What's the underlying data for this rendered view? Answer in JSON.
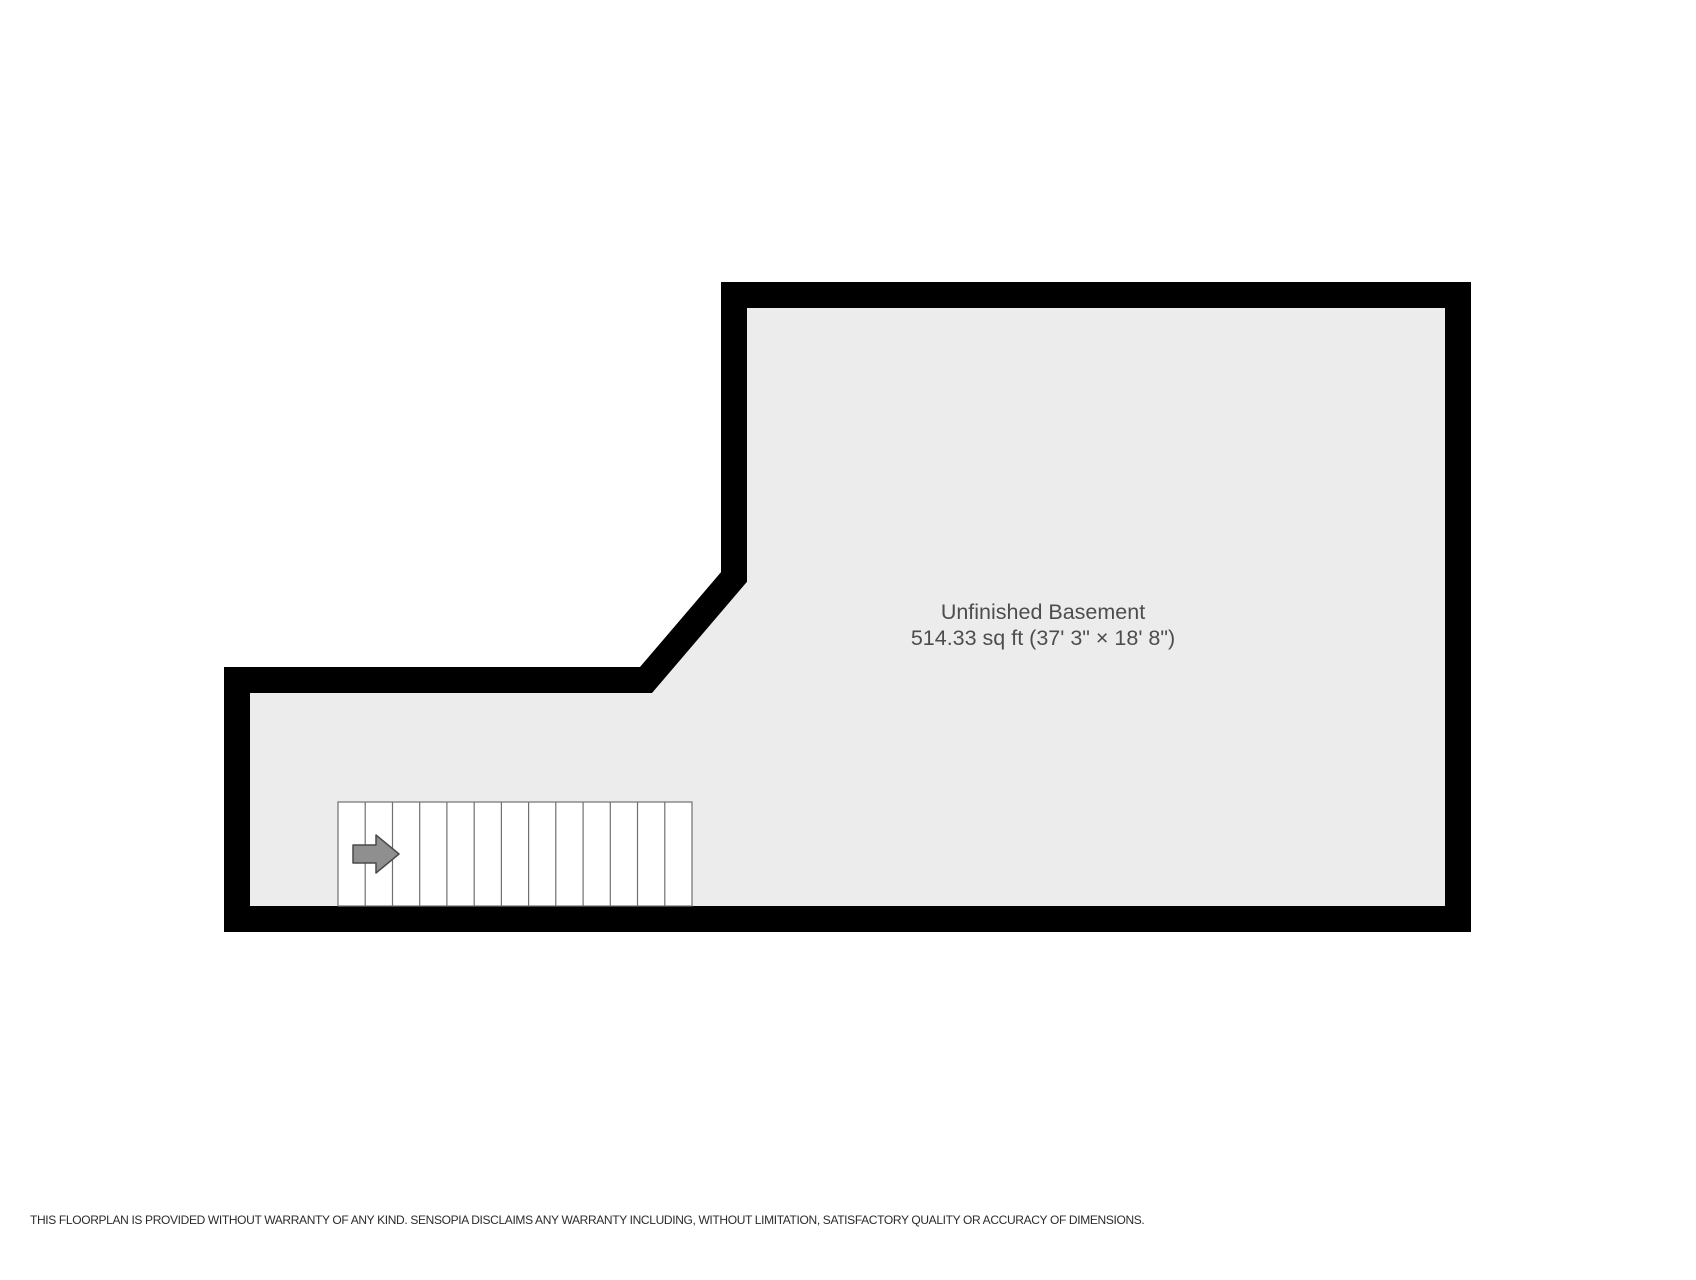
{
  "room": {
    "name": "Unfinished Basement",
    "area": "514.33 sq ft (37' 3\" × 18' 8\")"
  },
  "stairs": {
    "treads": 13,
    "direction": "right"
  },
  "icons": {
    "arrow": "stairs-direction-arrow"
  },
  "colors": {
    "wall": "#000000",
    "floor": "#ececec",
    "stair_fill": "#ffffff",
    "stair_stroke": "#707070",
    "arrow_fill": "#8f8f8f",
    "arrow_stroke": "#4a4a4a",
    "room_label": "#4d4d4d",
    "disclaimer": "#2b2b2b"
  },
  "disclaimer": "THIS FLOORPLAN IS PROVIDED WITHOUT WARRANTY OF ANY KIND. SENSOPIA DISCLAIMS ANY WARRANTY INCLUDING, WITHOUT LIMITATION, SATISFACTORY QUALITY OR ACCURACY OF DIMENSIONS."
}
